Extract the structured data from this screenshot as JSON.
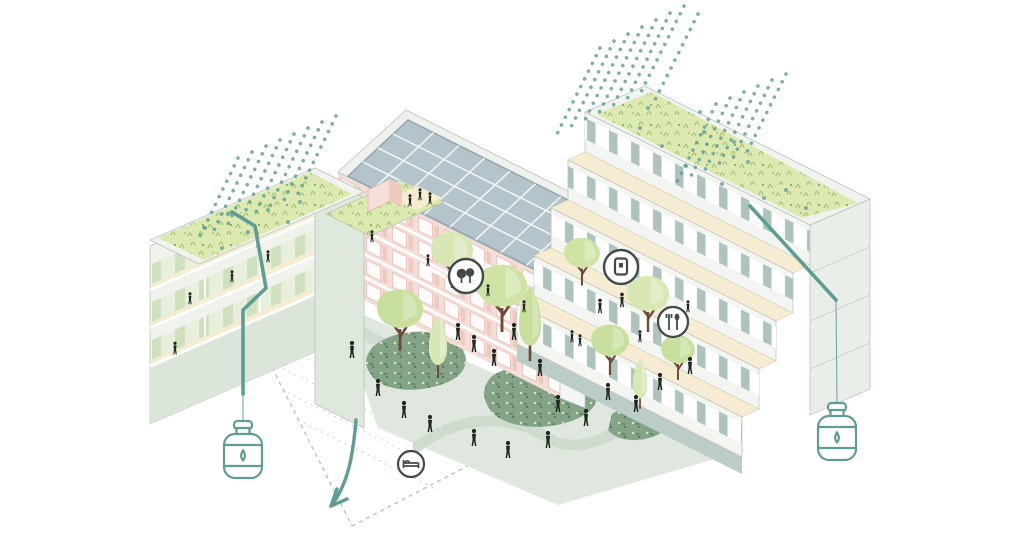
{
  "scene": {
    "description": "Axonometric architectural illustration of a residential block with green roofs, rooftop solar array, rainwater downpipes feeding two collection tanks, and a landscaped courtyard with trees, planting beds and people",
    "background": "#ffffff",
    "visible_text": []
  },
  "palette": {
    "teal": "#5e9c94",
    "ink": "#20261f",
    "icon": "#414b46",
    "roof_green": "#dce9b0",
    "grass": "#a5c478",
    "grass2": "#7fae62",
    "courtyard": "#dfe7df",
    "bed_green": "#85a387",
    "bed_dark": "#54775b",
    "bed_light": "#d7e6ba",
    "canopy": "#c8df9d",
    "canopy2": "#d8e8b4",
    "trunk": "#6d4b38",
    "pink": "#f4ded8",
    "pink2": "#eccabf",
    "solar": "#b4c4cb",
    "cream": "#f5ecd2",
    "panel": "#aec3be",
    "white_wall": "#f3f5f1",
    "sage_wall": "#dce5da",
    "path": "#ccd9cc",
    "dash": "#b6bfb6",
    "edge": "#b9c3bb"
  },
  "icons": {
    "trees-icon": "two tree silhouettes in a circle",
    "parcel-locker-icon": "rounded rectangle with inner square in a circle",
    "dining-icon": "fork and spoon in a circle",
    "bed-icon": "bed side view in a circle",
    "water-tank-icon": "ribbed barrel with cap and water drop",
    "water-drop-icon": "outlined water drop",
    "flow-arrow-icon": "curved arrow pointing down-left",
    "rain-icon": "slanted dotted lines",
    "person-icon": "small black human silhouette"
  },
  "features": {
    "rain_clusters": 3,
    "water_tanks": 2,
    "green_roofs": 3,
    "solar_array": true,
    "circular_badges": 4,
    "courtyard_trees": 10,
    "planting_beds": 6
  }
}
